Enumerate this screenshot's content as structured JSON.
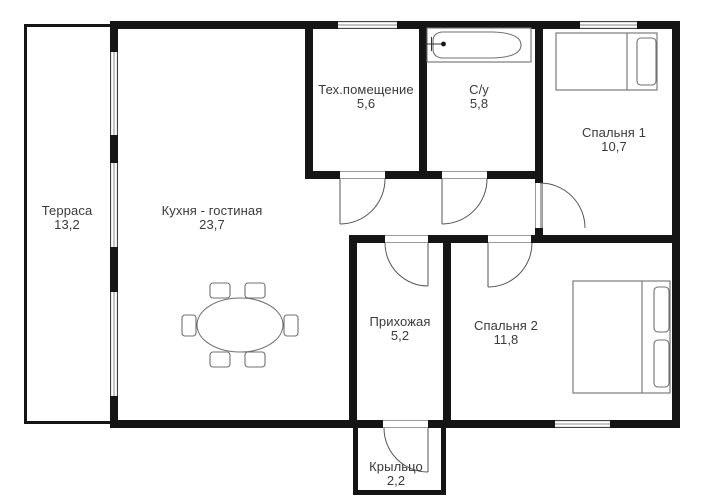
{
  "colors": {
    "wall": "#151515",
    "text": "#3a3a3a",
    "furniture_outline": "#707070"
  },
  "rooms": [
    {
      "id": "terrace",
      "name": "Терраса",
      "area": "13,2"
    },
    {
      "id": "kitchen-living",
      "name": "Кухня - гостиная",
      "area": "23,7"
    },
    {
      "id": "tech-room",
      "name": "Тех.помещение",
      "area": "5,6"
    },
    {
      "id": "bathroom",
      "name": "С/у",
      "area": "5,8"
    },
    {
      "id": "bedroom-1",
      "name": "Спальня 1",
      "area": "10,7"
    },
    {
      "id": "bedroom-2",
      "name": "Спальня 2",
      "area": "11,8"
    },
    {
      "id": "hallway",
      "name": "Прихожая",
      "area": "5,2"
    },
    {
      "id": "porch",
      "name": "Крыльцо",
      "area": "2,2"
    }
  ]
}
